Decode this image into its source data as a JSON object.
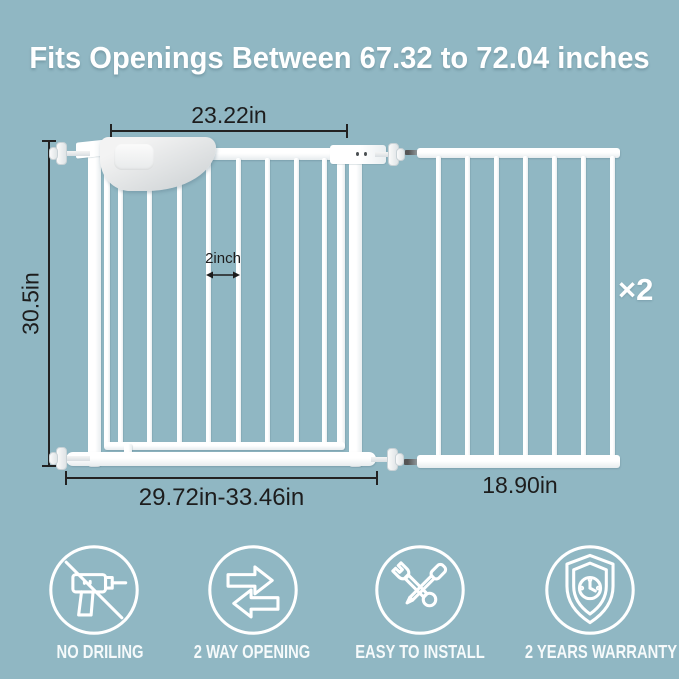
{
  "title": "Fits Openings Between 67.32 to 72.04 inches",
  "diagram": {
    "gate": {
      "door_width": "23.22in",
      "height": "30.5in",
      "bar_gap": "2inch",
      "overall_width": "29.72in-33.46in"
    },
    "extension": {
      "quantity": "×2",
      "width": "18.90in"
    }
  },
  "features": [
    {
      "icon": "no-drilling-icon",
      "label": "NO DRILING"
    },
    {
      "icon": "two-way-opening-icon",
      "label": "2 WAY OPENING"
    },
    {
      "icon": "easy-install-icon",
      "label": "EASY TO INSTALL"
    },
    {
      "icon": "warranty-shield-icon",
      "label": "2 YEARS WARRANTY"
    }
  ],
  "colors": {
    "background": "#90b7c3",
    "gate_white": "#fbfbfb",
    "measurement_text": "#1d1d1d",
    "icon_stroke": "#ffffff"
  }
}
